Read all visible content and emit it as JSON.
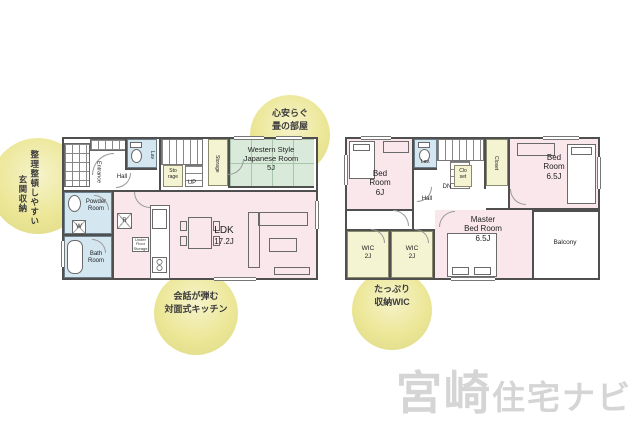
{
  "watermark": {
    "brand_large": "宮崎",
    "brand_small": "住宅ナビ"
  },
  "annotations": {
    "entrance_storage": {
      "line1": "整理整頓しやすい",
      "line2": "玄関収納"
    },
    "tatami_room": {
      "line1": "心安らぐ",
      "line2": "畳の部屋"
    },
    "kitchen": {
      "line1": "会話が弾む",
      "line2": "対面式キッチン"
    },
    "wic": {
      "line1": "たっぷり",
      "line2": "収納WIC"
    }
  },
  "floor1": {
    "entrance": "Entrance",
    "hall": "Hall",
    "lav": "Lav",
    "storage_small": {
      "line1": "Sto",
      "line2": "rage"
    },
    "up": "UP",
    "storage_tall": "Storage",
    "western_room": {
      "line1": "Western Style",
      "line2": "Japanese Room",
      "size": "5J"
    },
    "powder_room": {
      "line1": "Powder",
      "line2": "Room"
    },
    "washer": "W",
    "fridge": "R",
    "bath_room": {
      "line1": "Bath",
      "line2": "Room"
    },
    "under_floor": {
      "line1": "Under",
      "line2": "Floor",
      "line3": "Storage"
    },
    "ldk": {
      "name": "LDK",
      "size": "17.2J"
    }
  },
  "floor2": {
    "bed_room_6": {
      "line1": "Bed",
      "line2": "Room",
      "size": "6J"
    },
    "lav": "Lav.",
    "dn": "DN",
    "hall": "Hall",
    "closet_small": {
      "line1": "Clo",
      "line2": "set"
    },
    "closet_tall": "Closet",
    "bed_room_65": {
      "line1": "Bed",
      "line2": "Room",
      "size": "6.5J"
    },
    "wic1": {
      "name": "WIC",
      "size": "2J"
    },
    "wic2": {
      "name": "WIC",
      "size": "2J"
    },
    "master": {
      "line1": "Master",
      "line2": "Bed Room",
      "size": "6.5J"
    },
    "balcony": "Balcony"
  },
  "colors": {
    "room_pink": "#f9e7ec",
    "tatami_green": "#d9eada",
    "storage_yellow": "#f4f3d2",
    "wet_blue": "#d4e7f1",
    "wall": "#4f4f4f",
    "highlight_circle": "#e9e59b",
    "watermark_gray": "#d5d5d5"
  }
}
